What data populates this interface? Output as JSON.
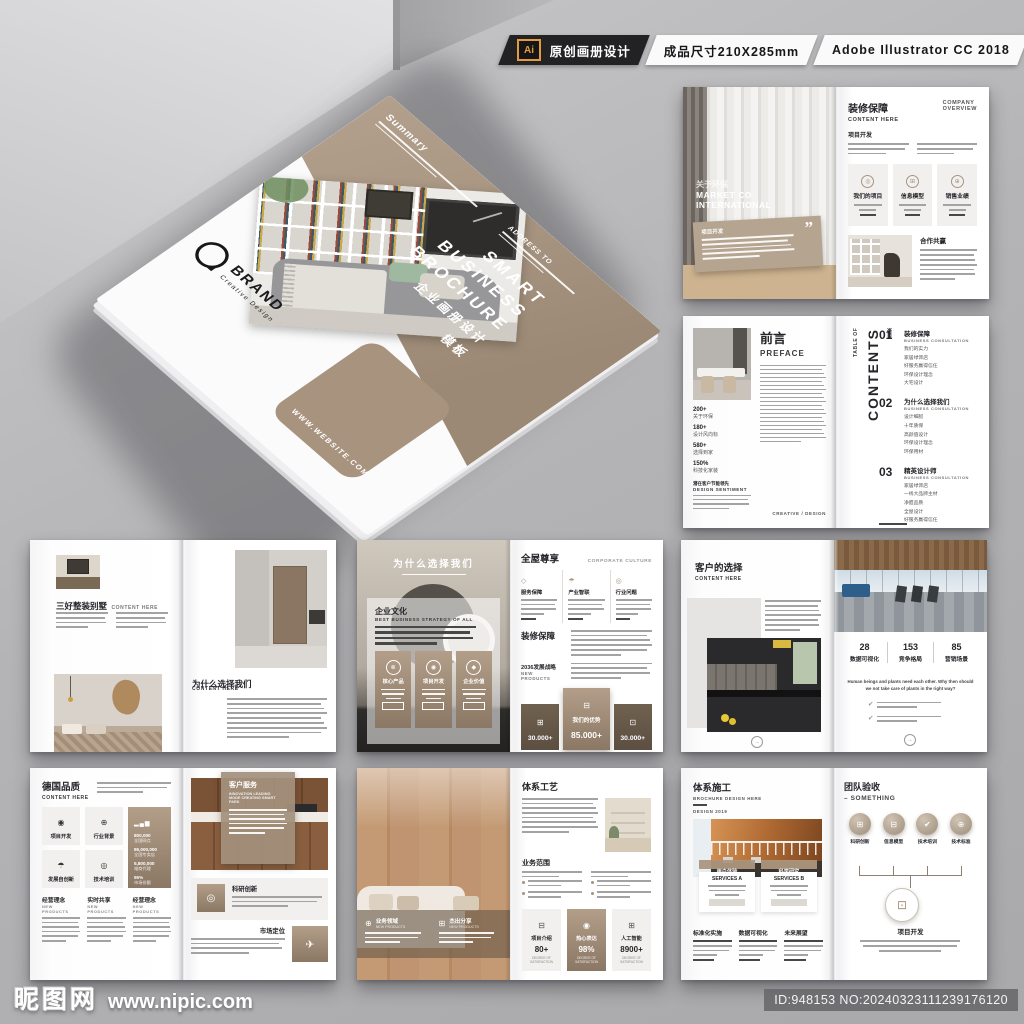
{
  "colors": {
    "accent_tan": "#a8937f",
    "band_tan": "#a2907c",
    "topbar_black": "#222224",
    "badge_orange": "#e39b3c"
  },
  "header": {
    "ai_badge": "Ai",
    "tag_original": "原创画册设计",
    "tag_size": "成品尺寸210X285mm",
    "tag_software": "Adobe Illustrator CC 2018"
  },
  "watermark": {
    "site_name": "昵图网",
    "site_url": "www.nipic.com",
    "image_id": "ID:948153 NO:20240323111239176120"
  },
  "cover": {
    "summary": "Summary",
    "address": "ADDRESS TO",
    "title_line1": "SMART",
    "title_line2": "BUSINESS",
    "title_line3": "BROCHURE",
    "title_cn": "企业画册设计",
    "title_cn_2": "模板",
    "brand": "BRAND",
    "brand_sub": "Creative Design",
    "website": "WWW.WEBSITE.COM"
  },
  "s1": {
    "left": {
      "cn": "关于环保",
      "en1": "MARKET CO",
      "en2": "INTERNATIONAL",
      "box_label": "项目开发",
      "quote": "”"
    },
    "right": {
      "title": "装修保障",
      "sub": "CONTENT HERE",
      "corner1": "COMPANY",
      "corner2": "OVERVIEW",
      "sec": "项目开发",
      "col1": "我们的项目",
      "col2": "信息模型",
      "col3": "销售业绩",
      "partner": "合作共赢"
    }
  },
  "s2": {
    "left": {
      "title": "前言",
      "sub": "PREFACE",
      "stats": [
        {
          "v": "200+",
          "l": "关于环保"
        },
        {
          "v": "180+",
          "l": "设计风向标"
        },
        {
          "v": "580+",
          "l": "选择到家"
        },
        {
          "v": "150%",
          "l": "科技化家装"
        }
      ],
      "sent_cn": "潜在客户节能领先",
      "sent_en": "DESIGN SENTIMENT",
      "credit": "CREATIVE / DESIGN"
    },
    "right": {
      "toc_cn": "目录",
      "toc_small": "TABLE OF",
      "toc_big": "CONTENTS",
      "items": [
        {
          "num": "01",
          "title": "装修保障",
          "sub": "BUSINESS CONSULTATION",
          "b": [
            "我们的实力",
            "家居绿饰店",
            "好服务赢得信任",
            "环保设计理念",
            "大宅设计"
          ]
        },
        {
          "num": "02",
          "title": "为什么选择我们",
          "sub": "BUSINESS CONSULTATION",
          "b": [
            "设计细腻",
            "十年质保",
            "高颜值设计",
            "环保设计理念",
            "环保用材"
          ]
        },
        {
          "num": "03",
          "title": "精英设计师",
          "sub": "BUSINESS CONSULTATION",
          "b": [
            "家居绿饰店",
            "一线大品牌主材",
            "净醛品质",
            "全屋设计",
            "好服务赢得信任"
          ]
        }
      ],
      "foot": "Many companies have a brief mission statement, usually in 30 words or fewer, explaining their reason for being and their guiding principles. If you want to draft a mission statement, this is a good place to put it in the plan."
    }
  },
  "s3": {
    "left": {
      "title": "三好整装别墅",
      "sub": "CONTENT HERE"
    },
    "right": {
      "title": "为什么选择我们",
      "sub": "CONTENT HERE"
    }
  },
  "s4": {
    "left": {
      "overlay_title": "为什么选择我们",
      "sec": "企业文化",
      "sec_sub": "BEST BUSINESS STRATEGY OF ALL",
      "card1": "核心产品",
      "card2": "项目开发",
      "card3": "企业价值"
    },
    "right": {
      "title": "全屋尊享",
      "corner": "CORPORATE CULTURE",
      "col1": "服务保障",
      "col2": "产业智联",
      "col3": "行业问题",
      "sec2": "装修保障",
      "sec3": "2036发展战略",
      "sec3_sub": "NEW PRODUCTS",
      "stat_left": "30.000+",
      "stat_mid_label": "我们的优势",
      "stat_mid": "85.000+",
      "stat_right": "30.000+"
    }
  },
  "s5": {
    "left": {
      "title": "客户的选择",
      "sub": "CONTENT HERE"
    },
    "right": {
      "v1": "28",
      "l1": "数据可视化",
      "v2": "153",
      "l2": "竞争格局",
      "v3": "85",
      "l3": "营销场景",
      "cap1": "Human beings and plants need each other. Why then should",
      "cap2": "we not take care of plants in the right way?"
    }
  },
  "s6": {
    "left": {
      "title": "德国品质",
      "sub": "CONTENT HERE",
      "box1": "项目开发",
      "box2": "行业背景",
      "box3": "发展自创新",
      "box4": "技术培训",
      "stats": [
        {
          "v": "800,000",
          "l": "全国网点"
        },
        {
          "v": "86,000,000",
          "l": "全国专卖店"
        },
        {
          "v": "5,800,000",
          "l": "电商代理"
        },
        {
          "v": "95%",
          "l": "市场份额"
        }
      ],
      "col1": "经营理念",
      "col2": "实时共享",
      "col3": "经营理念",
      "col_sub": "NEW PRODUCTS"
    },
    "right": {
      "card_title": "客户服务",
      "card_sub1": "INNOVATION LEADING",
      "card_sub2": "MODE CREATING SMART PARK",
      "item1": "科研创新",
      "item2": "市场定位"
    }
  },
  "s7": {
    "left": {
      "band1": "业务领域",
      "band1_sub": "NEW PRODUCTS",
      "band2": "杰出分享",
      "band2_sub": "NEW PRODUCTS"
    },
    "right": {
      "title": "体系工艺",
      "sec2": "业务范围",
      "c1_label": "项目介绍",
      "c1_value": "80+",
      "c2_label": "热心表达",
      "c2_value": "98%",
      "c3_label": "人工智能",
      "c3_value": "8900+",
      "c_sub": "DEGREE OF SATISFACTION"
    }
  },
  "s8": {
    "left": {
      "title": "体系施工",
      "sub1": "BROCHURE DESIGN HERE",
      "sub2": "DESIGN 2019",
      "tab1": "用户体验",
      "tab2": "科学研究",
      "srv1": "SERVICES A",
      "srv2": "SERVICES B",
      "col1": "标准化实施",
      "col2": "数据可视化",
      "col3": "未来展望"
    },
    "right": {
      "title": "团队验收",
      "sub": "– SOMETHING",
      "i1": "科研创新",
      "i2": "信息模型",
      "i3": "技术培训",
      "i4": "技术标准",
      "node": "项目开发"
    }
  }
}
